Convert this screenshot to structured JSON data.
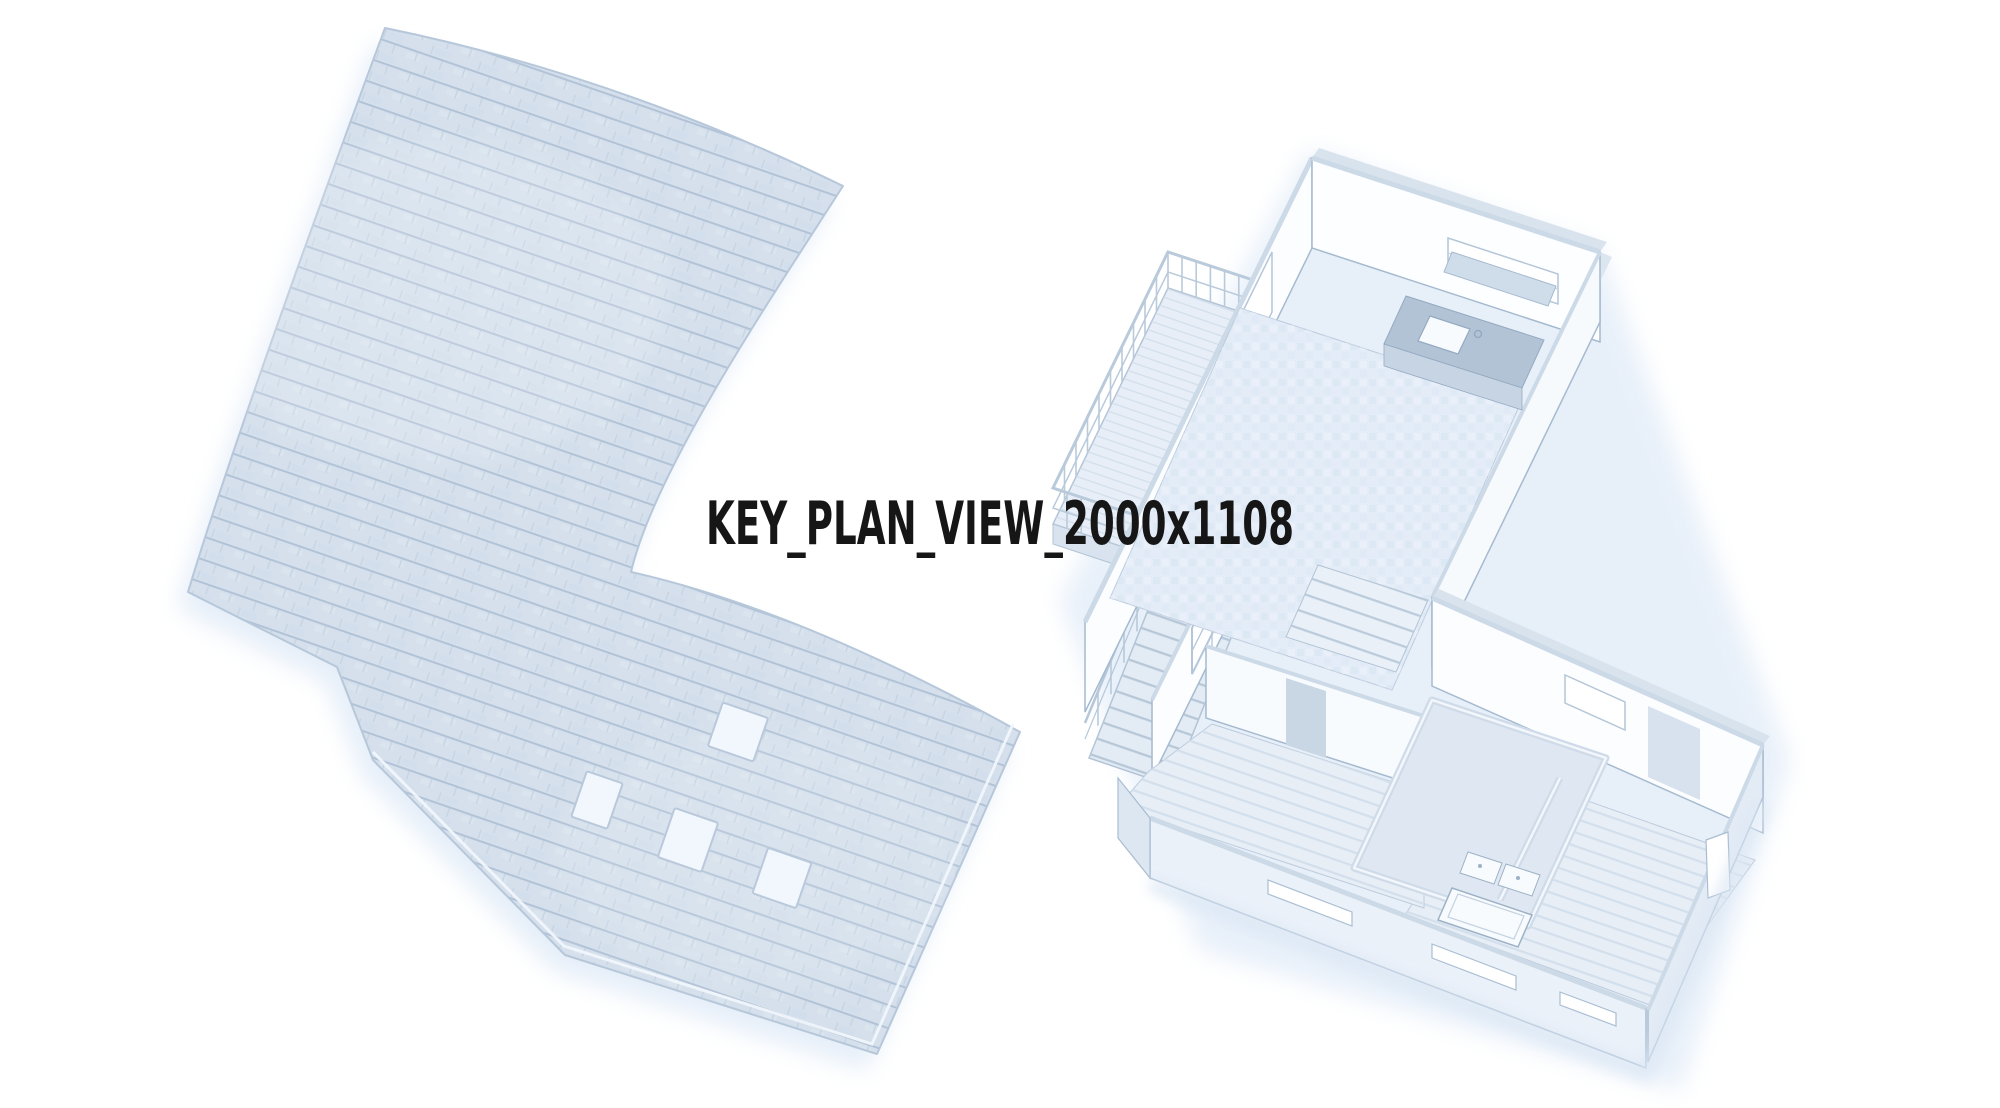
{
  "page": {
    "background": "#ffffff",
    "title": "KEY_PLAN_VIEW_2000x1108",
    "title_color": "#161616"
  },
  "scene": {
    "roof_plan": {
      "name": "shingled-roof-plan",
      "skylight_count": 4,
      "colors": {
        "fill": "#d5e0ec",
        "shingle_line": "#b2c3d7",
        "outline": "#b7c7da",
        "skylight_fill": "#f1f7fd",
        "shadow": "#dce8f6"
      }
    },
    "floor_plan": {
      "name": "isometric-floor-plan-cutaway",
      "colors": {
        "wall_face": "#fcfdff",
        "wall_top": "#ccd9e7",
        "wall_outline": "#a6bacf",
        "carpet_floor": "#e4edf7",
        "wood_floor": "#e7eef6",
        "counter": "#b2c3d6",
        "facade": "#ebf1f9",
        "fixture": "#f8fbfe",
        "ground_shadow": "#e2ecf8"
      }
    }
  }
}
